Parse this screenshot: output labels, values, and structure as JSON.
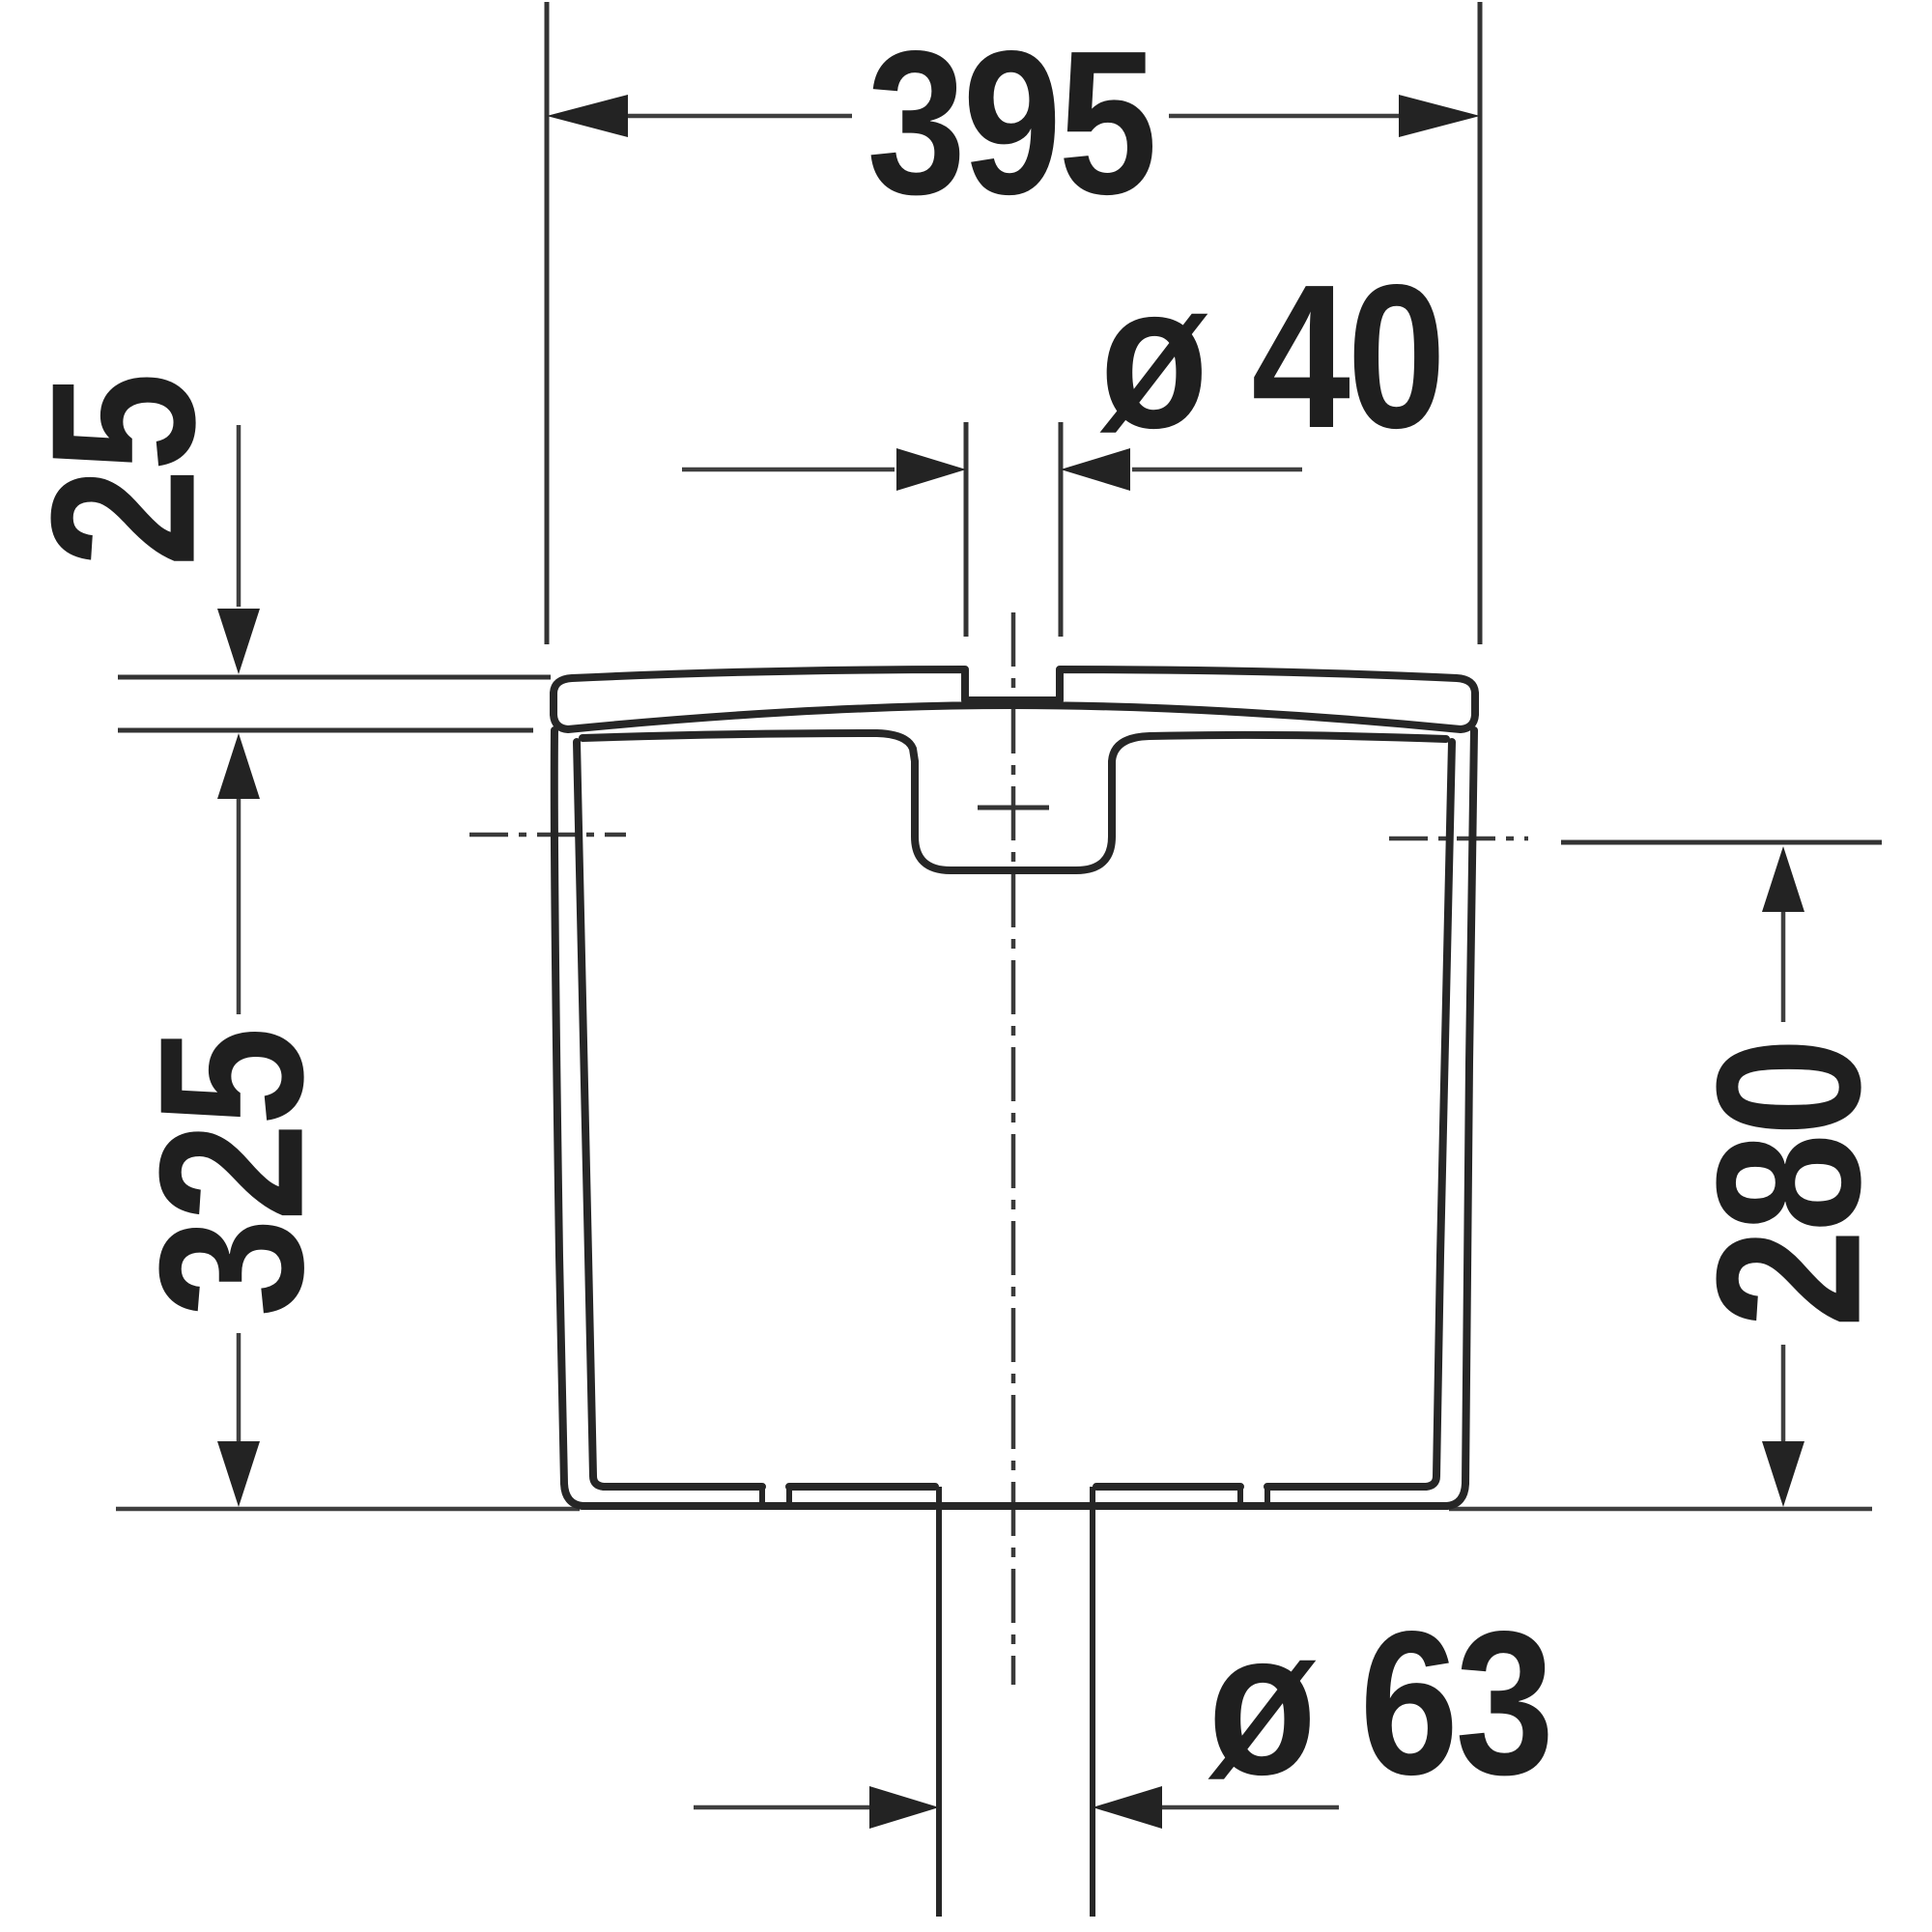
{
  "document": {
    "type": "technical-dimension-drawing",
    "subject": "toilet cistern front elevation",
    "background_color": "#ffffff",
    "line_color": "#262626",
    "dimension_line_color": "#3f3f3f",
    "text_color": "#1f1f1f"
  },
  "dimensions": {
    "top_width": {
      "label": "395"
    },
    "lid_inlet_diameter": {
      "label": "ø 40"
    },
    "lid_height": {
      "label": "25"
    },
    "total_height": {
      "label": "325"
    },
    "side_connection_height": {
      "label": "280"
    },
    "bottom_outlet_diameter": {
      "label": "ø 63"
    }
  }
}
